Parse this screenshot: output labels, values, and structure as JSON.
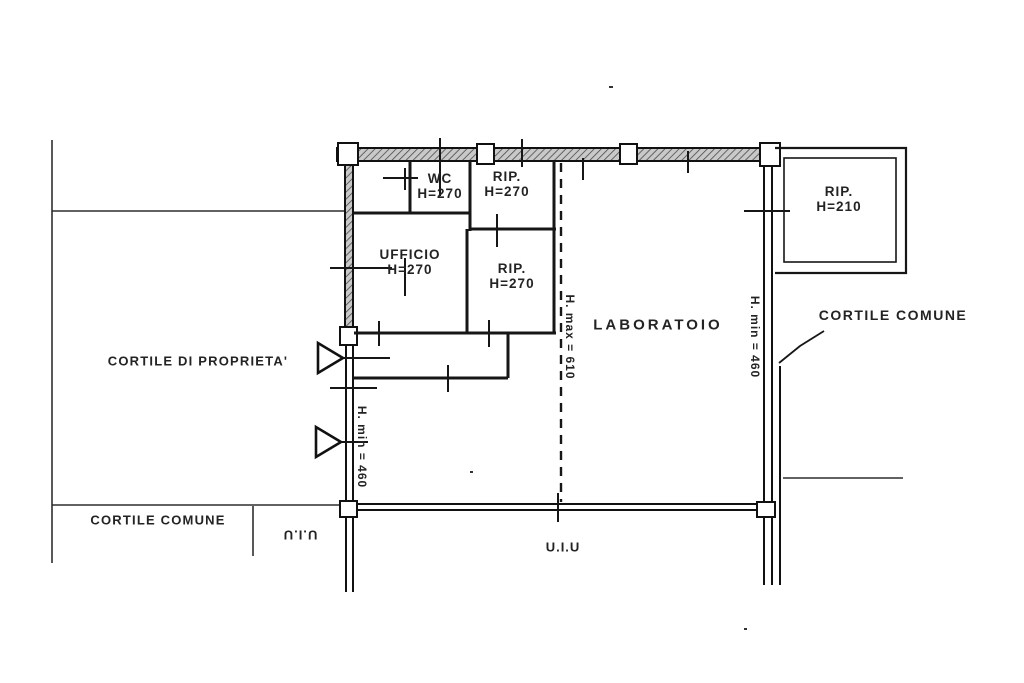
{
  "plan": {
    "rooms": {
      "wc": {
        "name": "WC",
        "height": "H=270"
      },
      "rip_top": {
        "name": "RIP.",
        "height": "H=270"
      },
      "ufficio": {
        "name": "UFFICIO",
        "height": "H=270"
      },
      "rip_mid": {
        "name": "RIP.",
        "height": "H=270"
      },
      "laboratorio": {
        "name": "LABORATOIO"
      },
      "rip_right": {
        "name": "RIP.",
        "height": "H=210"
      }
    },
    "areas": {
      "cortile_proprieta": "CORTILE DI PROPRIETA'",
      "cortile_comune_right": "CORTILE COMUNE",
      "cortile_comune_bottom": "CORTILE COMUNE",
      "uiu_bottom_left": "U.I.U",
      "uiu_bottom_center": "U.I.U"
    },
    "dimensions": {
      "h_min_left": "H. min = 460",
      "h_max_center": "H. max = 610",
      "h_min_right": "H. min = 460"
    },
    "colors": {
      "ink": "#1b1b1b",
      "paper": "#ffffff",
      "wall_fill": "#c9c9c9"
    }
  }
}
